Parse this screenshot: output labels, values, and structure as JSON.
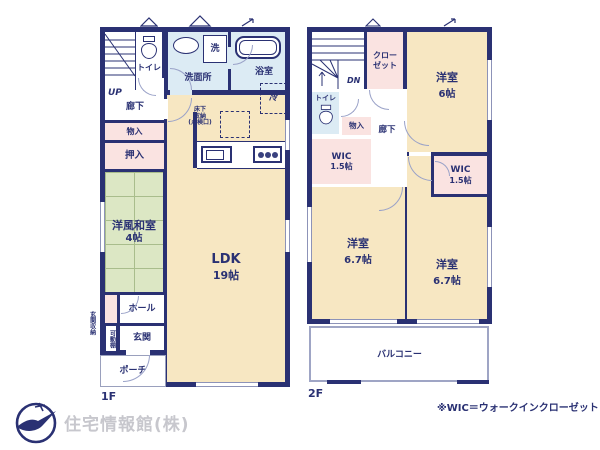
{
  "palette": {
    "wall": "#2a3173",
    "room_cream": "#f7e7c2",
    "closet_pink": "#fae3e1",
    "wet_blue": "#dcebf4",
    "tatami_green": "#dce7c4",
    "text_navy": "#2a3173",
    "logo_gray": "#c7c7cd"
  },
  "floor1": {
    "label": "1F",
    "stairs": "UP",
    "toilet": "トイレ",
    "washroom": "洗面所",
    "washer": "洗",
    "bath": "浴室",
    "corridor": "廊下",
    "storage": "物入",
    "oshiire": "押入",
    "tatami_name": "洋風和室",
    "tatami_size": "4帖",
    "fridge": "冷",
    "underfloor_1": "床下",
    "underfloor_2": "収納",
    "underfloor_3": "(点検口)",
    "ldk_name": "LDK",
    "ldk_size": "19帖",
    "hall": "ホール",
    "entrance": "玄関",
    "porch": "ポーチ",
    "shelf": "可動棚",
    "entrance_storage": "玄関収納"
  },
  "floor2": {
    "label": "2F",
    "stairs": "DN",
    "closet_1": "クロー",
    "closet_2": "ゼット",
    "bedroom1_name": "洋室",
    "bedroom1_size": "6帖",
    "toilet": "トイレ",
    "storage": "物入",
    "corridor": "廊下",
    "wic_left_name": "WIC",
    "wic_left_size": "1.5帖",
    "wic_right_name": "WIC",
    "wic_right_size": "1.5帖",
    "bedroom2_name": "洋室",
    "bedroom2_size": "6.7帖",
    "bedroom3_name": "洋室",
    "bedroom3_size": "6.7帖",
    "balcony": "バルコニー"
  },
  "footer": {
    "company": "住宅情報館(株)",
    "note": "※WIC＝ウォークインクローゼット"
  }
}
